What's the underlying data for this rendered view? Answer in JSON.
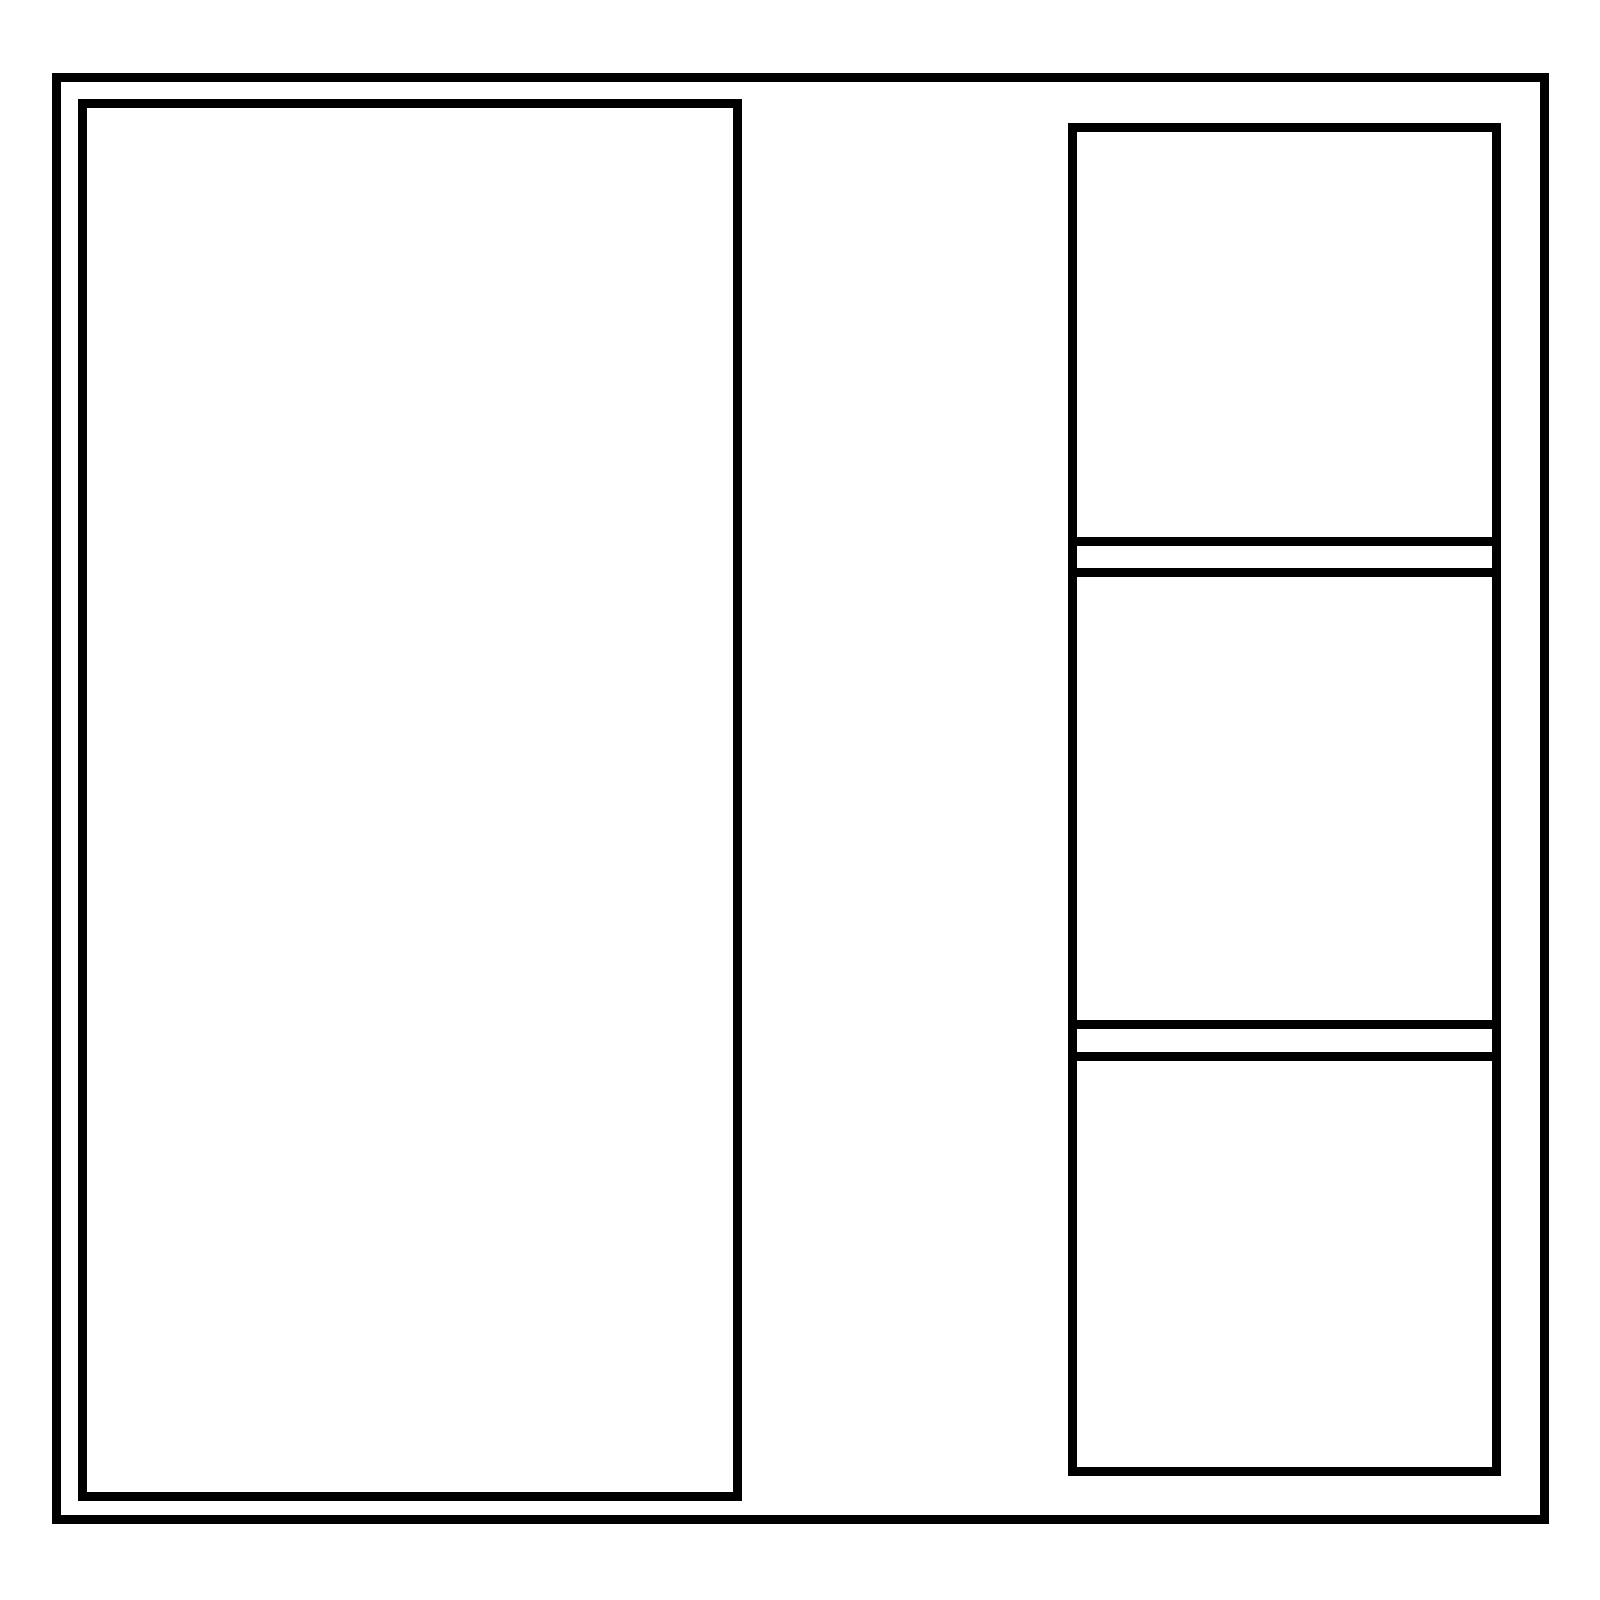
{
  "canvas": {
    "background_color": "#ffffff",
    "line_color": "#000000"
  },
  "right_column": {
    "section_count": 3,
    "divider_count": 2
  }
}
